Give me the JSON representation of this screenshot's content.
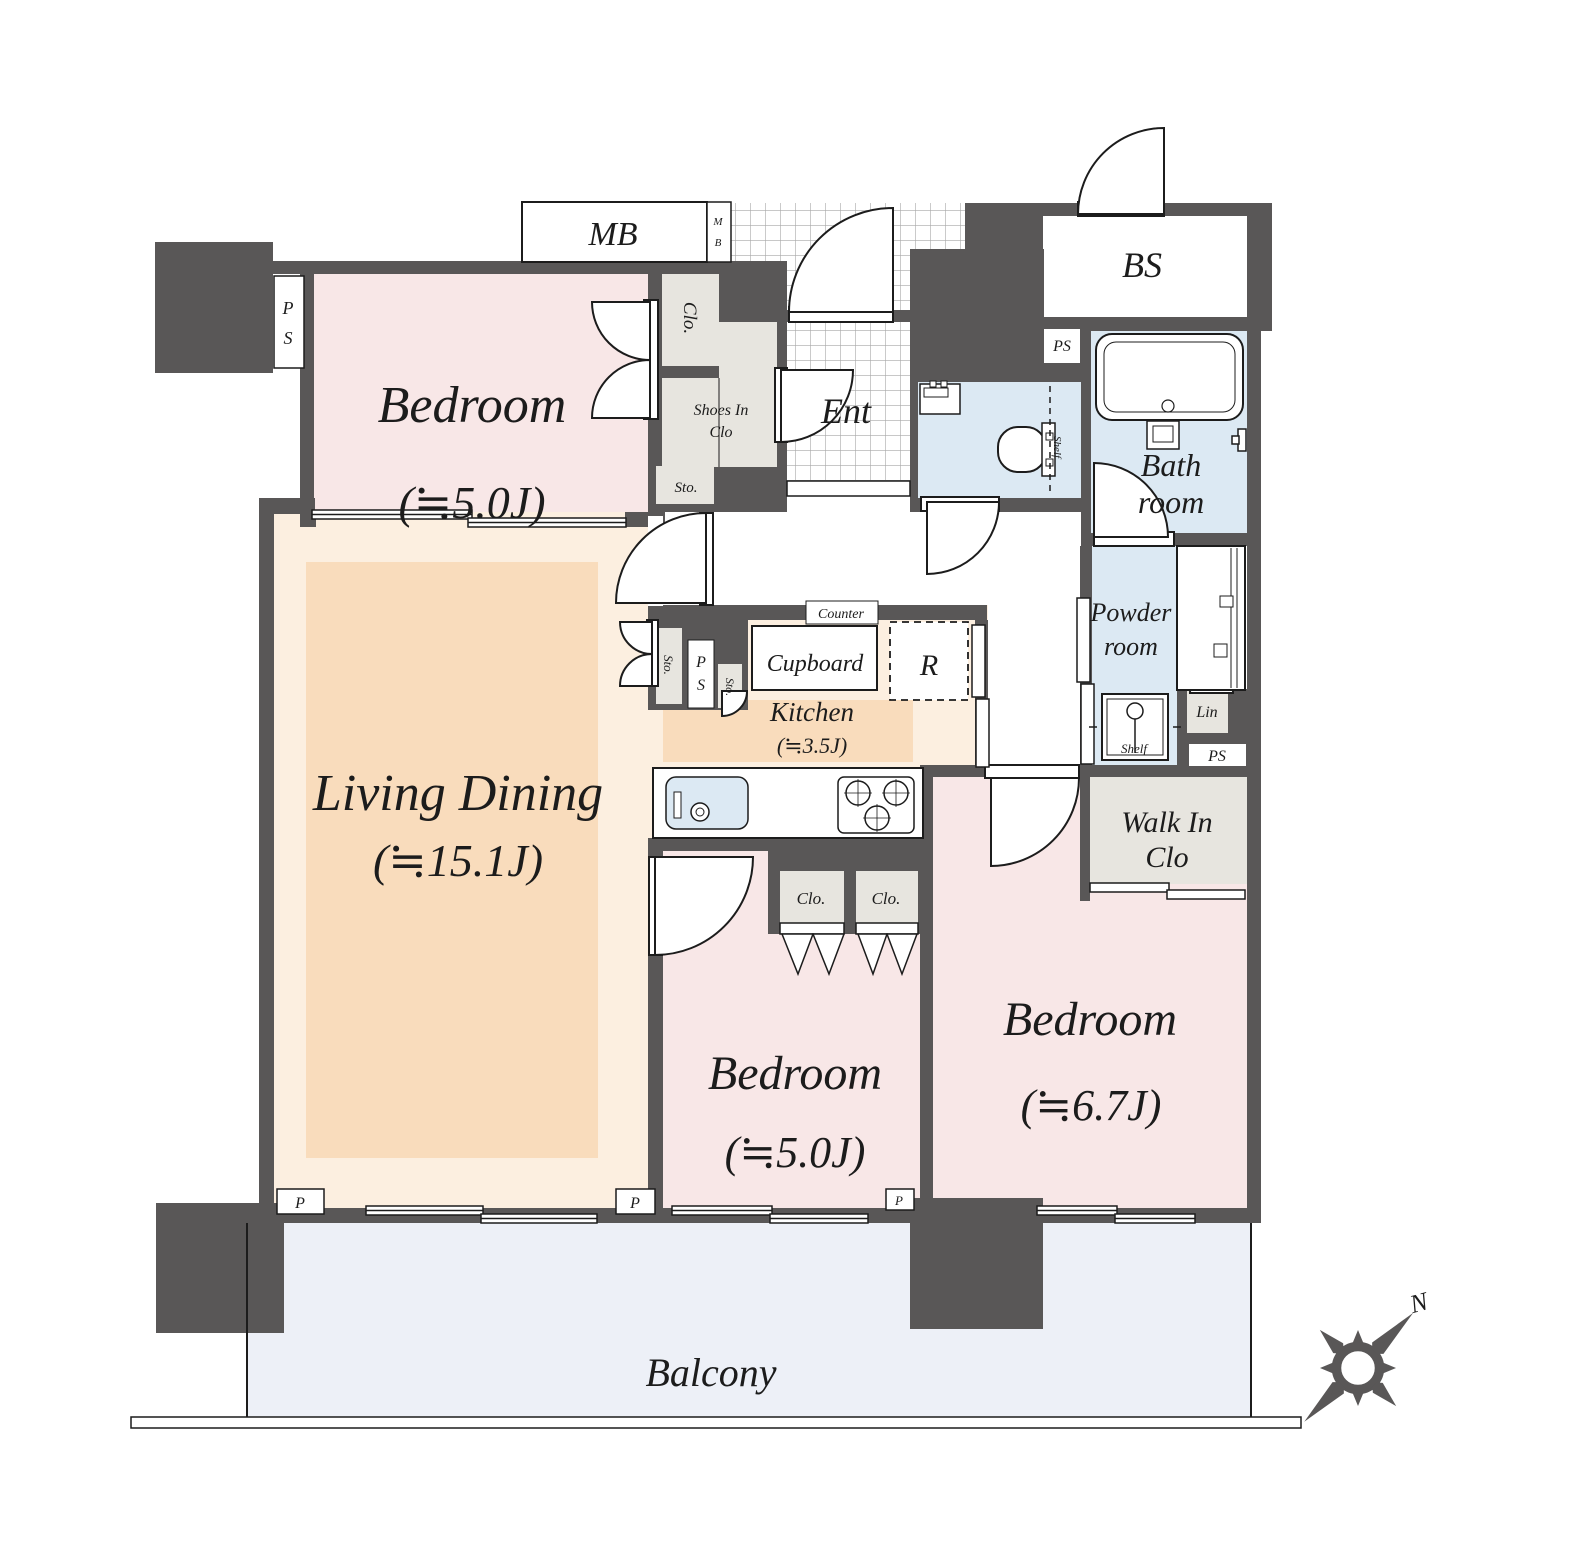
{
  "plan": {
    "rooms": {
      "bedroom_top": {
        "name": "Bedroom",
        "size": "(≒5.0J)"
      },
      "living_dining": {
        "name": "Living Dining",
        "size": "(≒15.1J)"
      },
      "kitchen": {
        "name": "Kitchen",
        "size": "(≒3.5J)"
      },
      "bedroom_center": {
        "name": "Bedroom",
        "size": "(≒5.0J)"
      },
      "bedroom_right": {
        "name": "Bedroom",
        "size": "(≒6.7J)"
      },
      "balcony": "Balcony",
      "entrance": "Ent",
      "bath": {
        "line1": "Bath",
        "line2": "room"
      },
      "powder": {
        "line1": "Powder",
        "line2": "room"
      },
      "walk_in_closet": {
        "line1": "Walk In",
        "line2": "Clo"
      },
      "bs": "BS",
      "mb": "MB",
      "mb_small": {
        "line1": "M",
        "line2": "B"
      }
    },
    "storage": {
      "closet_bedroom_top": "Clo.",
      "shoes_in_closet": {
        "line1": "Shoes In",
        "line2": "Clo"
      },
      "storage_hall": "Sto.",
      "storage_kitchen_left": "Sto.",
      "storage_kitchen_right": "Sto.",
      "closet_bedroom_center_left": "Clo.",
      "closet_bedroom_center_right": "Clo.",
      "linen": "Lin"
    },
    "kitchen_items": {
      "counter": "Counter",
      "cupboard": "Cupboard",
      "refrigerator": "R"
    },
    "shafts": {
      "ps_top_left": {
        "line1": "P",
        "line2": "S"
      },
      "ps_center": "PS",
      "ps_kitchen": {
        "line1": "P",
        "line2": "S"
      },
      "ps_bottom": "PS"
    },
    "shelves": {
      "toilet": "Shelf",
      "powder": "Shelf"
    },
    "pipes": {
      "p_left": "P",
      "p_center": "P",
      "p_right": "P"
    },
    "compass": {
      "north": "N"
    },
    "colors": {
      "wall": "#595757",
      "bedroom": "#f8e7e7",
      "living": "#fcefe0",
      "living_accent": "#f9dcbc",
      "wet_area": "#dce9f3",
      "closet": "#e7e5df",
      "balcony": "#edf0f7",
      "outline": "#1c1c1c"
    }
  }
}
